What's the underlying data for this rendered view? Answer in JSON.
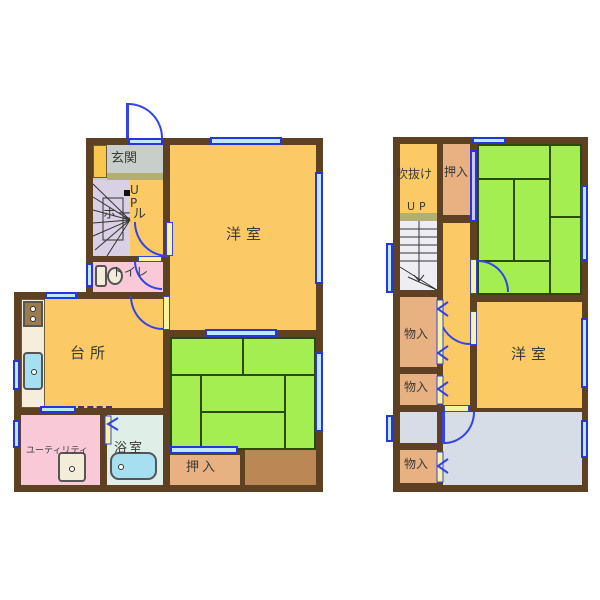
{
  "document_type": "floor-plan",
  "floor1": {
    "rooms": {
      "genkan": "玄関",
      "stairs_up": "UP",
      "hall": "ホール",
      "toilet": "トイレ",
      "western_room": "洋室",
      "kitchen": "台所",
      "utility": "ユーティリティ",
      "bath": "浴室",
      "closet": "押入"
    }
  },
  "floor2": {
    "rooms": {
      "void": "吹抜け",
      "closet": "押入",
      "stairs_up": "UP",
      "storage_labels": [
        "物入",
        "物入",
        "物入"
      ],
      "western_room": "洋室"
    }
  },
  "palette": {
    "wall": "#5E4123",
    "room_orange": "#FBCA65",
    "tatami_green": "#A5EE52",
    "closet_tan": "#E8B182",
    "alcove_brown": "#BB8755",
    "wet_pink": "#F9C9D8",
    "bath_pale": "#DFEEE6",
    "fixture_cyan": "#A5DFF0",
    "room_gray": "#D7DDE7",
    "genkan_gray": "#C8CEC9",
    "stair_lavender": "#D9D0E5",
    "counter_cream": "#F4EEDA",
    "cabinet_yellow": "#F7C84C",
    "window_blue": "#2736D8",
    "door_blue": "#3344E6",
    "step_olive": "#B3AF72",
    "text": "#3A3A3A"
  }
}
